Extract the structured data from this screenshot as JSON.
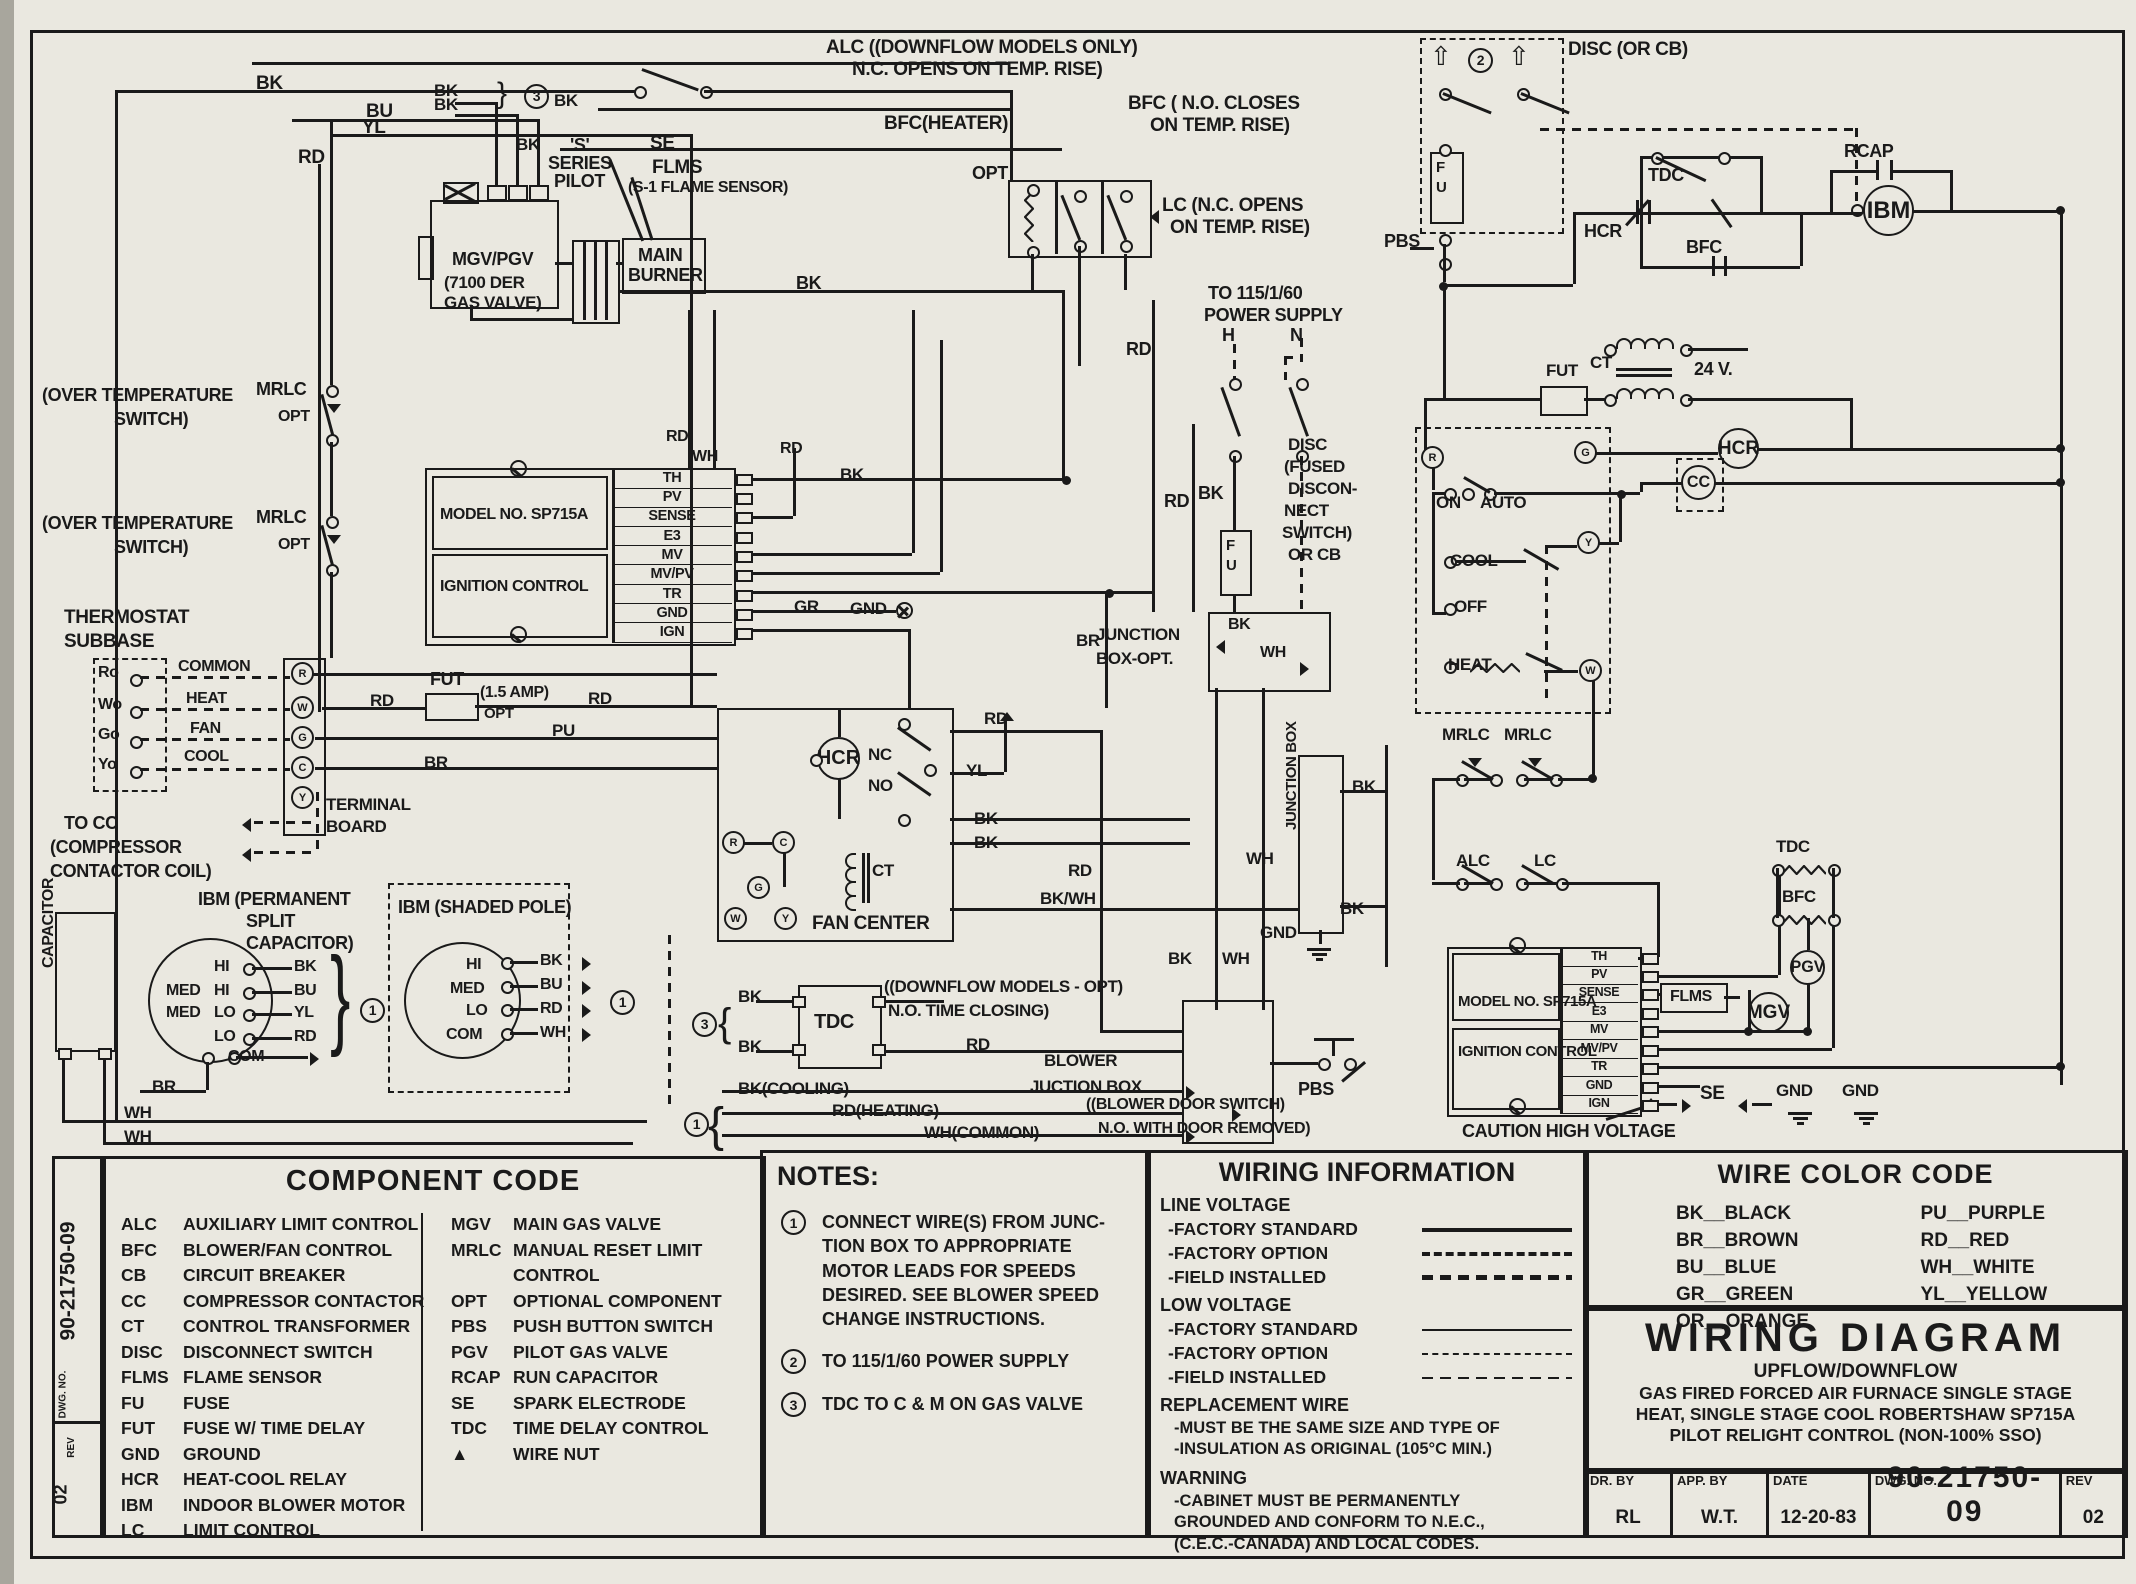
{
  "schematic": {
    "labels": {
      "BK": "BK",
      "BU": "BU",
      "YL": "YL",
      "RD": "RD",
      "WH": "WH",
      "BR": "BR",
      "PU": "PU",
      "GR": "GR",
      "BKWH": "BK/WH",
      "GND": "GND",
      "M1": "1",
      "M2": "2",
      "M3": "3",
      "BRACE_R": "}",
      "BRACE_L": "{",
      "S1": "'S'",
      "S2": "SERIES",
      "S3": "PILOT",
      "SE": "SE",
      "FLMS": "FLMS",
      "FLMS_SUB": "(S-1 FLAME SENSOR)",
      "MGV1": "MGV/PGV",
      "MGV2": "(7100 DER",
      "MGV3": "GAS VALVE)",
      "MAIN": "MAIN",
      "BURNER": "BURNER",
      "ALC1": "ALC ((DOWNFLOW MODELS ONLY)",
      "ALC2": "N.C. OPENS ON TEMP. RISE)",
      "BFCH": "BFC(HEATER)",
      "BFC1": "BFC ( N.O. CLOSES",
      "BFC2": "ON TEMP. RISE)",
      "OPT": "OPT",
      "LC1": "LC (N.C. OPENS",
      "LC2": "ON TEMP. RISE)",
      "PS1": "TO 115/1/60",
      "PS2": "POWER SUPPLY",
      "H": "H",
      "N": "N",
      "DISC1": "DISC",
      "DISC2": "(FUSED",
      "DISC3": "DISCON-",
      "DISC4": "NECT",
      "DISC5": "SWITCH)",
      "DISC6": "OR CB",
      "F": "F",
      "U": "U",
      "JB1": "JUNCTION",
      "JB2": "BOX-OPT.",
      "JBV": "JUNCTION BOX",
      "OT1": "(OVER TEMPERATURE",
      "OT2": "SWITCH)",
      "MRLC": "MRLC",
      "TS1": "THERMOSTAT",
      "TS2": "SUBBASE",
      "RO": "Ro",
      "WO": "Wo",
      "GO": "Go",
      "YO": "Yo",
      "COMMON": "COMMON",
      "HEAT": "HEAT",
      "FAN": "FAN",
      "COOL": "COOL",
      "TB1": "TERMINAL",
      "TB2": "BOARD",
      "TOCC1": "TO CC",
      "TOCC2": "(COMPRESSOR",
      "TOCC3": "CONTACTOR COIL)",
      "FUT": "FUT",
      "AMP": "(1.5 AMP)",
      "MODEL": "MODEL NO. SP715A",
      "IGNC": "IGNITION CONTROL",
      "HCR": "HCR",
      "NC": "NC",
      "NO": "NO",
      "CT": "CT",
      "FANC": "FAN CENTER",
      "R": "R",
      "C": "C",
      "G": "G",
      "W": "W",
      "Y": "Y",
      "CAPV": "CAPACITOR",
      "IBM1": "IBM (PERMANENT",
      "IBM2": "SPLIT",
      "IBM3": "CAPACITOR)",
      "IBMS": "IBM (SHADED POLE)",
      "HI": "HI",
      "MED": "MED",
      "LO": "LO",
      "COM": "COM",
      "TDC": "TDC",
      "DFM": "((DOWNFLOW MODELS - OPT)",
      "NTC": "N.O. TIME CLOSING)",
      "BLW1": "BLOWER",
      "BLW2": "JUCTION BOX",
      "BKCOOL": "BK(COOLING)",
      "RDHEAT": "RD(HEATING)",
      "WHCOM": "WH(COMMON)",
      "BDS1": "((BLOWER DOOR SWITCH)",
      "BDS2": "N.O. WITH DOOR REMOVED)",
      "PBS": "PBS",
      "DISCCB": "DISC (OR CB)",
      "PLUG": "⇧",
      "BFC": "BFC",
      "RCAP": "RCAP",
      "IBM": "IBM",
      "V24": "24 V.",
      "ON": "ON",
      "AUTO": "AUTO",
      "OFF": "OFF",
      "CC": "CC",
      "ALC": "ALC",
      "LCS": "LC",
      "PGV": "PGV",
      "MGVC": "MGV",
      "CAUTION": "CAUTION HIGH VOLTAGE"
    },
    "ign_terminals": [
      "TH",
      "PV",
      "SENSE",
      "E3",
      "MV",
      "MV/PV",
      "TR",
      "GND",
      "IGN"
    ]
  },
  "legend": {
    "strip": {
      "dwg_label": "DWG. NO.",
      "dwg_no": "90-21750-09",
      "rev_label": "REV",
      "rev_no": "02"
    },
    "component_code": {
      "title": "COMPONENT CODE",
      "left": [
        {
          "c": "ALC",
          "d": "AUXILIARY LIMIT CONTROL"
        },
        {
          "c": "BFC",
          "d": "BLOWER/FAN CONTROL"
        },
        {
          "c": "CB",
          "d": "CIRCUIT BREAKER"
        },
        {
          "c": "CC",
          "d": "COMPRESSOR CONTACTOR"
        },
        {
          "c": "CT",
          "d": "CONTROL TRANSFORMER"
        },
        {
          "c": "DISC",
          "d": "DISCONNECT SWITCH"
        },
        {
          "c": "FLMS",
          "d": "FLAME SENSOR"
        },
        {
          "c": "FU",
          "d": "FUSE"
        },
        {
          "c": "FUT",
          "d": "FUSE W/ TIME DELAY"
        },
        {
          "c": "GND",
          "d": "GROUND"
        },
        {
          "c": "HCR",
          "d": "HEAT-COOL RELAY"
        },
        {
          "c": "IBM",
          "d": "INDOOR BLOWER MOTOR"
        },
        {
          "c": "LC",
          "d": "LIMIT CONTROL"
        }
      ],
      "right": [
        {
          "c": "MGV",
          "d": "MAIN GAS VALVE"
        },
        {
          "c": "MRLC",
          "d": "MANUAL RESET LIMIT\nCONTROL"
        },
        {
          "c": "OPT",
          "d": "OPTIONAL COMPONENT"
        },
        {
          "c": "PBS",
          "d": "PUSH BUTTON SWITCH"
        },
        {
          "c": "PGV",
          "d": "PILOT GAS VALVE"
        },
        {
          "c": "RCAP",
          "d": "RUN CAPACITOR"
        },
        {
          "c": "SE",
          "d": "SPARK ELECTRODE"
        },
        {
          "c": "TDC",
          "d": "TIME DELAY CONTROL"
        },
        {
          "c": "▲",
          "d": "WIRE NUT"
        }
      ]
    },
    "notes": {
      "title": "NOTES:",
      "items": [
        {
          "n": "1",
          "t": "CONNECT WIRE(S) FROM JUNC-\nTION BOX TO APPROPRIATE\nMOTOR LEADS FOR SPEEDS\nDESIRED. SEE BLOWER SPEED\nCHANGE INSTRUCTIONS."
        },
        {
          "n": "2",
          "t": "TO 115/1/60 POWER SUPPLY"
        },
        {
          "n": "3",
          "t": "TDC TO C & M ON GAS VALVE"
        }
      ]
    },
    "wiring_info": {
      "title": "WIRING INFORMATION",
      "sections": [
        {
          "heading": "LINE VOLTAGE",
          "rows": [
            {
              "label": "-FACTORY STANDARD",
              "style": "solid-thick"
            },
            {
              "label": "-FACTORY OPTION",
              "style": "dashdot-thick"
            },
            {
              "label": "-FIELD INSTALLED",
              "style": "dashed-thick"
            }
          ]
        },
        {
          "heading": "LOW VOLTAGE",
          "rows": [
            {
              "label": "-FACTORY STANDARD",
              "style": "solid-thin"
            },
            {
              "label": "-FACTORY OPTION",
              "style": "dashdot-thin"
            },
            {
              "label": "-FIELD INSTALLED",
              "style": "dashed-thin"
            }
          ]
        }
      ],
      "replacement": {
        "heading": "REPLACEMENT WIRE",
        "lines": "-MUST BE THE SAME SIZE AND TYPE OF\n-INSULATION AS ORIGINAL (105°C MIN.)"
      },
      "warning": {
        "heading": "WARNING",
        "lines": "-CABINET MUST BE PERMANENTLY\nGROUNDED AND CONFORM TO N.E.C.,\n(C.E.C.-CANADA) AND LOCAL CODES."
      }
    },
    "wire_color_code": {
      "title": "WIRE COLOR CODE",
      "left": [
        "BK__BLACK",
        "BR__BROWN",
        "BU__BLUE",
        "GR__GREEN",
        "OR__ORANGE"
      ],
      "right": [
        "PU__PURPLE",
        "RD__RED",
        "WH__WHITE",
        "YL__YELLOW"
      ]
    },
    "title_block": {
      "title": "WIRING DIAGRAM",
      "lines": [
        "UPFLOW/DOWNFLOW",
        "GAS FIRED FORCED AIR FURNACE SINGLE STAGE",
        "HEAT, SINGLE STAGE COOL ROBERTSHAW SP715A",
        "PILOT RELIGHT CONTROL (NON-100% SSO)"
      ],
      "fields": [
        {
          "l": "DR. BY",
          "v": "RL"
        },
        {
          "l": "APP. BY",
          "v": "W.T."
        },
        {
          "l": "DATE",
          "v": "12-20-83"
        },
        {
          "l": "DWG. NO.",
          "v": "90-21750-09"
        },
        {
          "l": "REV",
          "v": "02"
        }
      ]
    }
  }
}
